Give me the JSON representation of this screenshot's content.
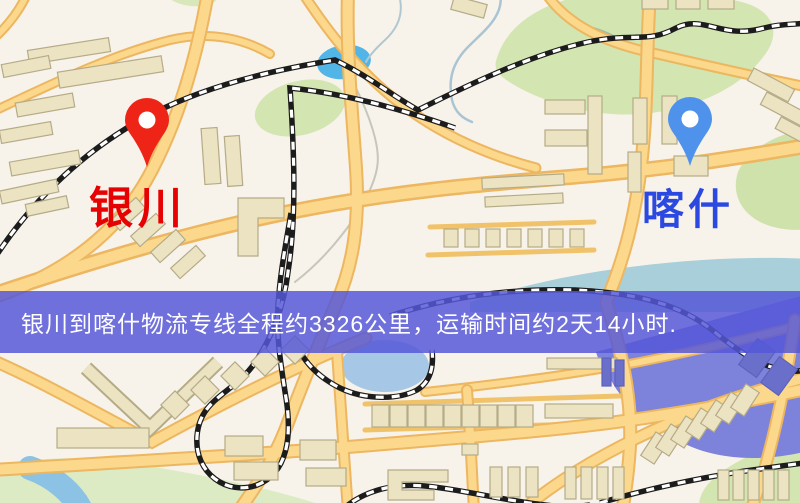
{
  "banner": {
    "text": "银川到喀什物流专线全程约3326公里，运输时间约2天14小时.",
    "background_color": "#5557d8",
    "text_color": "#ffffff"
  },
  "markers": {
    "origin": {
      "name": "银川",
      "label_color": "#e60202",
      "pin_color": "#ee2416"
    },
    "destination": {
      "name": "喀什",
      "label_color": "#2b49e0",
      "pin_color": "#4f92ec"
    }
  },
  "map": {
    "type": "stylized-street-map",
    "colors": {
      "background": "#f7f3ea",
      "road_fill": "#fbd88c",
      "road_edge": "#edb660",
      "park_green": "#d3e5b0",
      "river_blue": "#8cc3e4",
      "lake_blue": "#51b5e8",
      "railway_black": "#1c1c1c",
      "building_beige": "#ece3c3",
      "district_overlay_purple": "#7d82da"
    }
  }
}
